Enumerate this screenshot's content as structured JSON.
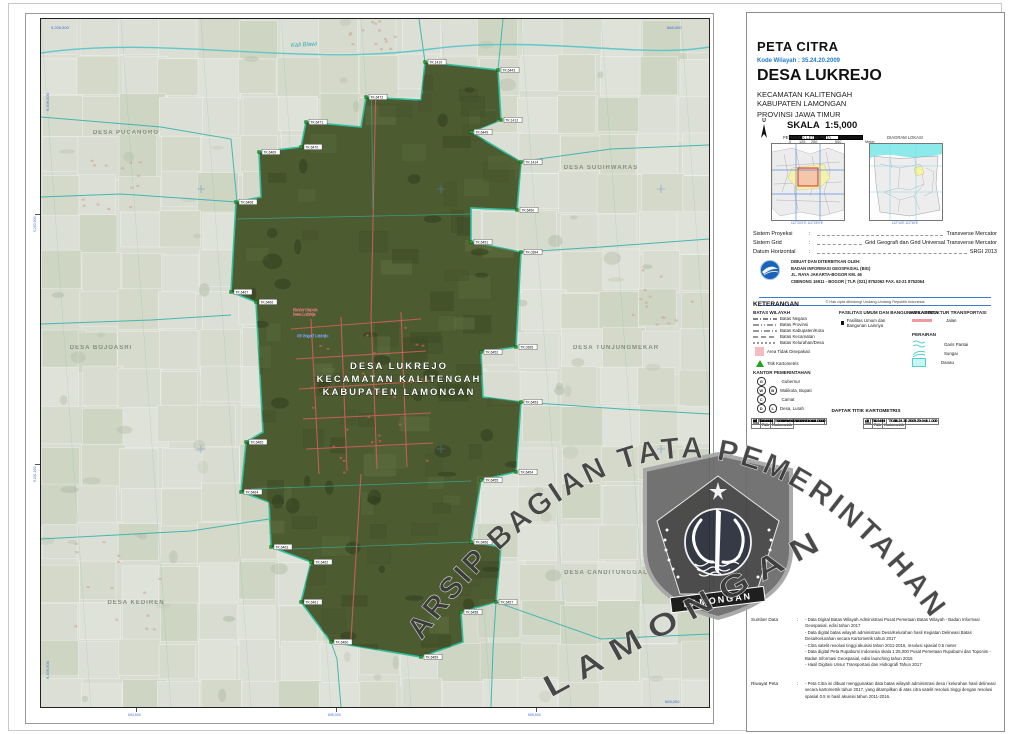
{
  "sheet": {
    "doc_type": "PETA CITRA",
    "kode_wilayah": "Kode Wilayah : 35.24.20.2009",
    "village": "DESA LUKREJO",
    "kecamatan": "KECAMATAN KALITENGAH",
    "kabupaten": "KABUPATEN LAMONGAN",
    "provinsi": "PROVINSI JAWA TIMUR"
  },
  "compass": {
    "label": "U"
  },
  "scale": {
    "label": "SKALA",
    "value": "1:5,000",
    "ticks": [
      "0",
      "125",
      "250",
      "500"
    ],
    "unit": "Meter"
  },
  "insets": {
    "left_title": "PETUNJUK LETAK PETA",
    "right_title": "DIAGRAM LOKASI",
    "left_labels": "112°20'0\"E      112°25'0\"E",
    "right_labels": "112°10'E        112°40'E"
  },
  "projection": {
    "sep": ":",
    "rows": [
      {
        "label": "Sistem Proyeksi",
        "value": "Transverse Mercator"
      },
      {
        "label": "Sistem Grid",
        "value": "Grid Geografi dan Grid Universal Transverse Mercator"
      },
      {
        "label": "Datum Horizontal",
        "value": "SRGI 2013"
      }
    ]
  },
  "publisher": {
    "issued_by": "DIBUAT DAN DITERBITKAN OLEH:",
    "agency": "BADAN INFORMASI GEOSPASIAL (BIG)",
    "address": "JL. RAYA JAKARTA-BOGOR KM. 46",
    "contact": "CIBINONG 16911 - BOGOR | TLP. (021) 8752062 FAX. 62-21 8752064",
    "copyright": "© Hak cipta dilindungi Undang-Undang Republik Indonesia"
  },
  "legend": {
    "title": "KETERANGAN",
    "batas_title": "BATAS WILAYAH",
    "batas_items": [
      "Batas Negara",
      "Batas Provinsi",
      "Batas Kabupaten/Kota",
      "Batas Kecamatan",
      "Batas Kelurahan/Desa"
    ],
    "area_label": "Area Tidak Disepakati",
    "titik_label": "Titik Kartometris",
    "fasilitas_title": "FASILITAS UMUM DAN BANGUNAN LAINNYA",
    "fasilitas_item": "Fasilitas Umum dan Bangunan Lainnya",
    "infra_title": "INFRASTRUKTUR TRANSPORTASI",
    "infra_item": "Jalan",
    "perairan_title": "PERAIRAN",
    "perairan_items": [
      "Garis Pantai",
      "Sungai",
      "Danau"
    ],
    "kantor_title": "KANTOR PEMERINTAHAN",
    "kantor_items": [
      {
        "sym": "G",
        "sym2": "",
        "label": "Gubernur"
      },
      {
        "sym": "W",
        "sym2": "B",
        "label": "Walikota, Bupati"
      },
      {
        "sym": "C",
        "sym2": "",
        "label": "Camat"
      },
      {
        "sym": "D",
        "sym2": "L",
        "label": "Desa, Lurah"
      }
    ]
  },
  "kartometris": {
    "title": "DAFTAR TITIK KARTOMETRIS",
    "headers": [
      "No.",
      "No. Titik",
      "Titik Kartometrik"
    ],
    "left_rows": [
      [
        1,
        "TK.0394",
        "TK.35.24.20.2009.20.001.1.000"
      ],
      [
        2,
        "TK.0395",
        "TK.35.24.20.2009.20.002.1.000"
      ],
      [
        3,
        "TK.0396",
        "TK.35.24.20.2009.20.003.1.000"
      ],
      [
        4,
        "TK.6429",
        "TK.35.24.20.2009.20.004.1.000"
      ],
      [
        5,
        "TK.6430",
        "TK.35.24.20.2009.20.005.1.000"
      ],
      [
        6,
        "TK.6431",
        "TK.35.24.20.2009.20.006.1.000"
      ],
      [
        7,
        "TK.6432",
        "TK.35.24.20.2009.20.007.1.000"
      ],
      [
        8,
        "TK.6433",
        "TK.35.24.20.2009.20.008.1.000"
      ],
      [
        9,
        "TK.6434",
        "TK.35.24.20.2009.20.009.1.000"
      ],
      [
        10,
        "TK.6435",
        "TK.35.24.20.2009.20.010.1.000"
      ],
      [
        11,
        "TK.6436",
        "TK.35.24.20.2009.20.011.1.000"
      ],
      [
        12,
        "TK.6437",
        "TK.35.24.20.2009.20.012.1.000"
      ],
      [
        13,
        "TK.6438",
        "TK.35.24.20.2009.20.013.1.000"
      ],
      [
        14,
        "TK.6439",
        "TK.35.24.20.2009.20.014.1.000"
      ],
      [
        15,
        "TK.6440",
        "TK.35.24.20.2009.20.015.1.000"
      ],
      [
        16,
        "TK.6441",
        "TK.35.24.20.2009.20.016.1.000"
      ],
      [
        17,
        "TK.6442",
        "TK.35.24.20.2009.20.017.1.000"
      ],
      [
        18,
        "TK.6443",
        "TK.35.24.20.2009.20.018.1.000"
      ],
      [
        19,
        "TK.6444",
        "TK.35.24.20.2009.20.019.1.000"
      ],
      [
        20,
        "TK.6445",
        "TK.35.24.20.2009.20.020.1.000"
      ],
      [
        21,
        "TK.6446",
        "TK.35.24.20.2009.20.021.1.000"
      ],
      [
        22,
        "TK.6447",
        "TK.35.24.20.2009.20.022.1.000"
      ],
      [
        23,
        "TK.6448",
        "TK.35.24.20.2009.20.023.1.000"
      ],
      [
        24,
        "TK.6449",
        "TK.35.24.20.2009.20.024.1.000"
      ],
      [
        25,
        "TK.6450",
        "TK.35.24.20.2009.20.025.1.000"
      ],
      [
        26,
        "TK.6451",
        "TK.35.24.20.2009.20.026.1.000"
      ],
      [
        27,
        "TK.6452",
        "TK.35.24.20.2009.20.027.1.000"
      ],
      [
        28,
        "TK.6453",
        "TK.35.24.20.2009.20.028.1.000"
      ],
      [
        29,
        "TK.6454",
        "TK.35.24.20.2009.20.029.1.000"
      ],
      [
        30,
        "TK.6455",
        "TK.35.24.20.2009.20.030.1.000"
      ],
      [
        31,
        "TK.6456",
        "TK.35.24.20.2009.20.031.1.000"
      ],
      [
        32,
        "TK.6457",
        "TK.35.24.20.2009.20.032.1.000"
      ],
      [
        33,
        "TK.6458",
        "TK.35.24.20.2009.20.033.1.000"
      ],
      [
        34,
        "TK.6459",
        "TK.35.24.20.2009.20.034.1.000"
      ],
      [
        35,
        "TK.6460",
        "TK.35.24.20.2009.20.035.1.000"
      ],
      [
        36,
        "TK.6461",
        "TK.35.24.20.2009.20.036.1.000"
      ],
      [
        37,
        "TK.6462",
        "TK.35.24.20.2009.20.037.1.000"
      ],
      [
        38,
        "TK.6463",
        "TK.35.24.20.2009.20.038.1.000"
      ],
      [
        39,
        "TK.6464",
        "TK.35.24.20.2009.20.039.1.000"
      ],
      [
        40,
        "TK.6465",
        "TK.35.24.20.2009.20.040.1.000"
      ]
    ],
    "right_rows": [
      [
        41,
        "TK.6466",
        "TK.35.24.20.2009.20.041.1.000"
      ],
      [
        42,
        "TK.6467",
        "TK.35.24.20.2009.20.042.1.000"
      ],
      [
        43,
        "TK.6468",
        "TK.35.24.20.2009.20.043.1.000"
      ],
      [
        44,
        "TK.6469",
        "TK.35.24.20.2009.20.044.1.000"
      ],
      [
        45,
        "TK.6470",
        "TK.35.24.20.2009.20.045.1.000"
      ],
      [
        46,
        "TK.6471",
        "TK.35.24.20.2009.20.046.1.000"
      ],
      [
        47,
        "TK.6472",
        "TK.35.24.20.2009.20.047.1.000"
      ],
      [
        48,
        "TK.6473",
        "TK.35.24.20.2009.20.048.1.000"
      ]
    ]
  },
  "sumber": {
    "label": "Sumber Data",
    "sep": ":",
    "items": [
      "- Data Digital Batas Wilayah Administrasi Pusat Pemetaan Batas Wilayah - Badan Informasi Geospasial, edisi tahun 2017",
      "- Data digital batas wilayah administrasi Desa/Kelurahan hasil Kegiatan Delineasi Batas Desa/Kelurahan secara Kartometrik tahun 2017",
      "- Citra satelit resolusi tinggi akuisisi tahun 2011-2016, resolusi spasial 0.5 meter",
      "- Data digital Peta Rupabumi Indonesia skala 1:25,000 Pusat Pemetaan Rupabumi dan Toponim - Badan Informasi Geospasial, edisi launching tahun 2016",
      "- Hasil Digitasi Unsur Transportasi dan Hidrografi Tahun 2017"
    ]
  },
  "riwayat": {
    "label": "Riwayat Peta",
    "sep": ":",
    "items": [
      "- Peta Citra ini dibuat menggunakan data batas wilayah administrasi desa / kelurahan hasil delineasi secara kartometrik tahun 2017, yang ditampilkan di atas citra satelit resolusi tinggi dengan resolusi spasial 0.5 m hasil akuisisi tahun 2011-2016."
    ]
  },
  "map": {
    "center_labels": [
      "DESA LUKREJO",
      "KECAMATAN KALITENGAH",
      "KABUPATEN LAMONGAN"
    ],
    "river_label": "Kali Blawi",
    "poi": [
      {
        "x": 252,
        "y": 292,
        "color": "#c22222",
        "lines": [
          "Kantor Kepala",
          "Desa Lukrejo"
        ]
      },
      {
        "x": 256,
        "y": 318,
        "color": "#1a56c4",
        "lines": [
          "SD Negeri Lukrejo"
        ]
      }
    ],
    "neighbors": [
      {
        "x": 85,
        "y": 115,
        "label": "DESA PUCANGRO"
      },
      {
        "x": 560,
        "y": 150,
        "label": "DESA SUGIHWARAS"
      },
      {
        "x": 575,
        "y": 330,
        "label": "DESA TUNJUNGMEKAR"
      },
      {
        "x": 565,
        "y": 555,
        "label": "DESA CANDITUNGGAL"
      },
      {
        "x": 95,
        "y": 585,
        "label": "DESA KEDIREN"
      },
      {
        "x": 60,
        "y": 330,
        "label": "DESA BOJOASRI"
      }
    ],
    "points": [
      {
        "x": 384,
        "y": 43,
        "label": "TK.1410"
      },
      {
        "x": 457,
        "y": 51,
        "label": "TK.6443"
      },
      {
        "x": 460,
        "y": 101,
        "label": "TK.1412"
      },
      {
        "x": 430,
        "y": 113,
        "label": "TK.6449"
      },
      {
        "x": 480,
        "y": 143,
        "label": "TK.1414"
      },
      {
        "x": 476,
        "y": 191,
        "label": "TK.6450"
      },
      {
        "x": 430,
        "y": 223,
        "label": "TK.6451"
      },
      {
        "x": 480,
        "y": 233,
        "label": "TK.0394"
      },
      {
        "x": 475,
        "y": 328,
        "label": "TK.0395"
      },
      {
        "x": 440,
        "y": 333,
        "label": "TK.6452"
      },
      {
        "x": 480,
        "y": 383,
        "label": "TK.6453"
      },
      {
        "x": 475,
        "y": 453,
        "label": "TK.6454"
      },
      {
        "x": 440,
        "y": 461,
        "label": "TK.6455"
      },
      {
        "x": 430,
        "y": 523,
        "label": "TK.6456"
      },
      {
        "x": 455,
        "y": 583,
        "label": "TK.6457"
      },
      {
        "x": 420,
        "y": 593,
        "label": "TK.6458"
      },
      {
        "x": 380,
        "y": 638,
        "label": "TK.6459"
      },
      {
        "x": 290,
        "y": 623,
        "label": "TK.6460"
      },
      {
        "x": 260,
        "y": 583,
        "label": "TK.6461"
      },
      {
        "x": 270,
        "y": 543,
        "label": "TK.6462"
      },
      {
        "x": 230,
        "y": 528,
        "label": "TK.6463"
      },
      {
        "x": 200,
        "y": 473,
        "label": "TK.6464"
      },
      {
        "x": 205,
        "y": 423,
        "label": "TK.6465"
      },
      {
        "x": 215,
        "y": 283,
        "label": "TK.6466"
      },
      {
        "x": 190,
        "y": 273,
        "label": "TK.6467"
      },
      {
        "x": 195,
        "y": 183,
        "label": "TK.6468"
      },
      {
        "x": 218,
        "y": 133,
        "label": "TK.6469"
      },
      {
        "x": 260,
        "y": 128,
        "label": "TK.6470"
      },
      {
        "x": 265,
        "y": 103,
        "label": "TK.6471"
      },
      {
        "x": 325,
        "y": 78,
        "label": "TK.6472"
      }
    ],
    "corner_labels": [
      {
        "x": 10,
        "y": 10,
        "t": "9,206,500"
      },
      {
        "x": 8,
        "y": 92,
        "t": "9,206,000",
        "v": 1
      },
      {
        "x": 626,
        "y": 10,
        "t": "668,000"
      },
      {
        "x": 8,
        "y": 660,
        "t": "9,199,500",
        "v": 1
      },
      {
        "x": 624,
        "y": 684,
        "t": "668,000"
      }
    ],
    "edge_ticks": {
      "bottom": [
        "694,500",
        "695,000",
        "695,500"
      ],
      "left": [
        "9,203,000",
        "9,201,000"
      ]
    }
  },
  "watermark": {
    "arc_text": "ARSIP BAGIAN TATA PEMERINTAHAN",
    "diag_text": "LAMONGAN",
    "crest_banner": "LAMONGAN"
  }
}
